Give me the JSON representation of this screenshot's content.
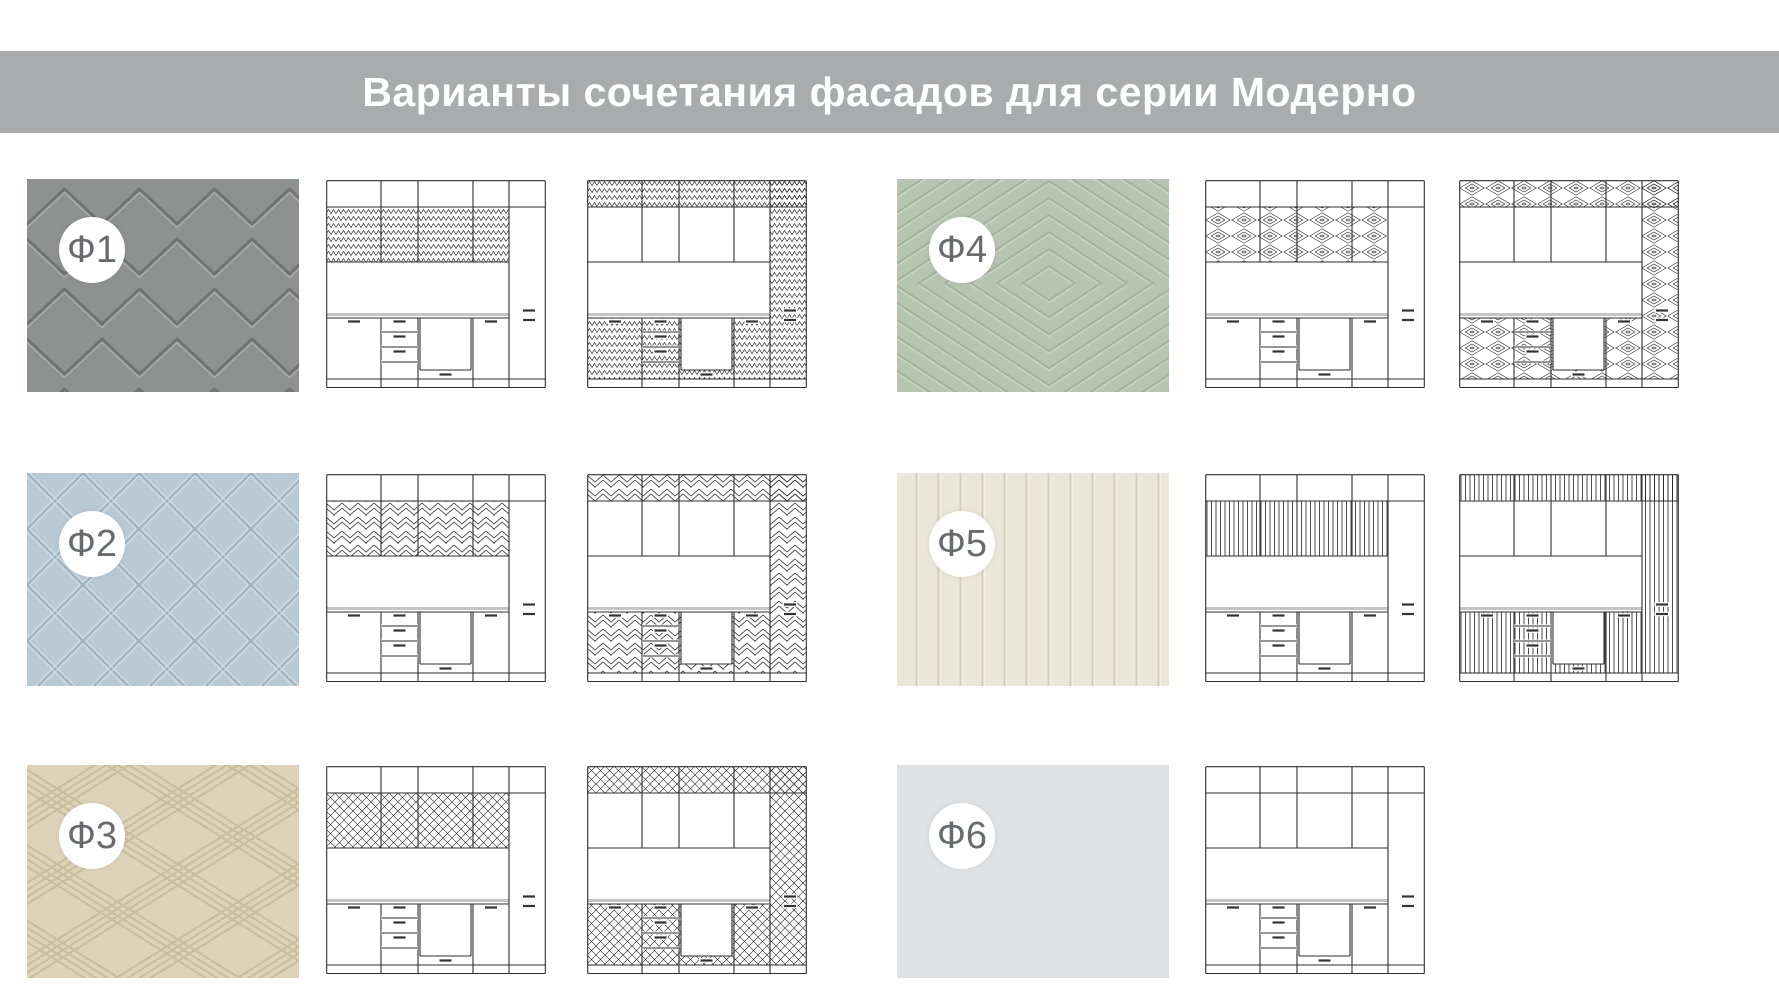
{
  "banner": {
    "title": "Варианты сочетания фасадов для серии Модерно",
    "bg_color": "#a9abad",
    "text_color": "#ffffff"
  },
  "legend": {
    "badge_bg": "#ffffff",
    "badge_text_color": "#686b6d",
    "drawing_line_color": "#2e2e2e"
  },
  "facades": [
    {
      "id": "f1",
      "label": "Ф1",
      "pattern": "chevron-emboss",
      "color": "#8e9190",
      "drawings": [
        "accent-upper",
        "accent-wrap"
      ]
    },
    {
      "id": "f2",
      "label": "Ф2",
      "pattern": "herringbone-panels",
      "color": "#b9c9d4",
      "drawings": [
        "accent-upper",
        "accent-wrap"
      ]
    },
    {
      "id": "f3",
      "label": "Ф3",
      "pattern": "diagonal-weave",
      "color": "#ded3b9",
      "drawings": [
        "accent-upper",
        "accent-wrap"
      ]
    },
    {
      "id": "f4",
      "label": "Ф4",
      "pattern": "concentric-diamonds",
      "color": "#b6c5b1",
      "drawings": [
        "accent-upper",
        "accent-wrap"
      ]
    },
    {
      "id": "f5",
      "label": "Ф5",
      "pattern": "vertical-slats",
      "color": "#e9e6da",
      "drawings": [
        "accent-upper",
        "accent-wrap"
      ]
    },
    {
      "id": "f6",
      "label": "Ф6",
      "pattern": "plain",
      "color": "#dfe2e4",
      "drawings": [
        "accent-upper"
      ]
    }
  ]
}
